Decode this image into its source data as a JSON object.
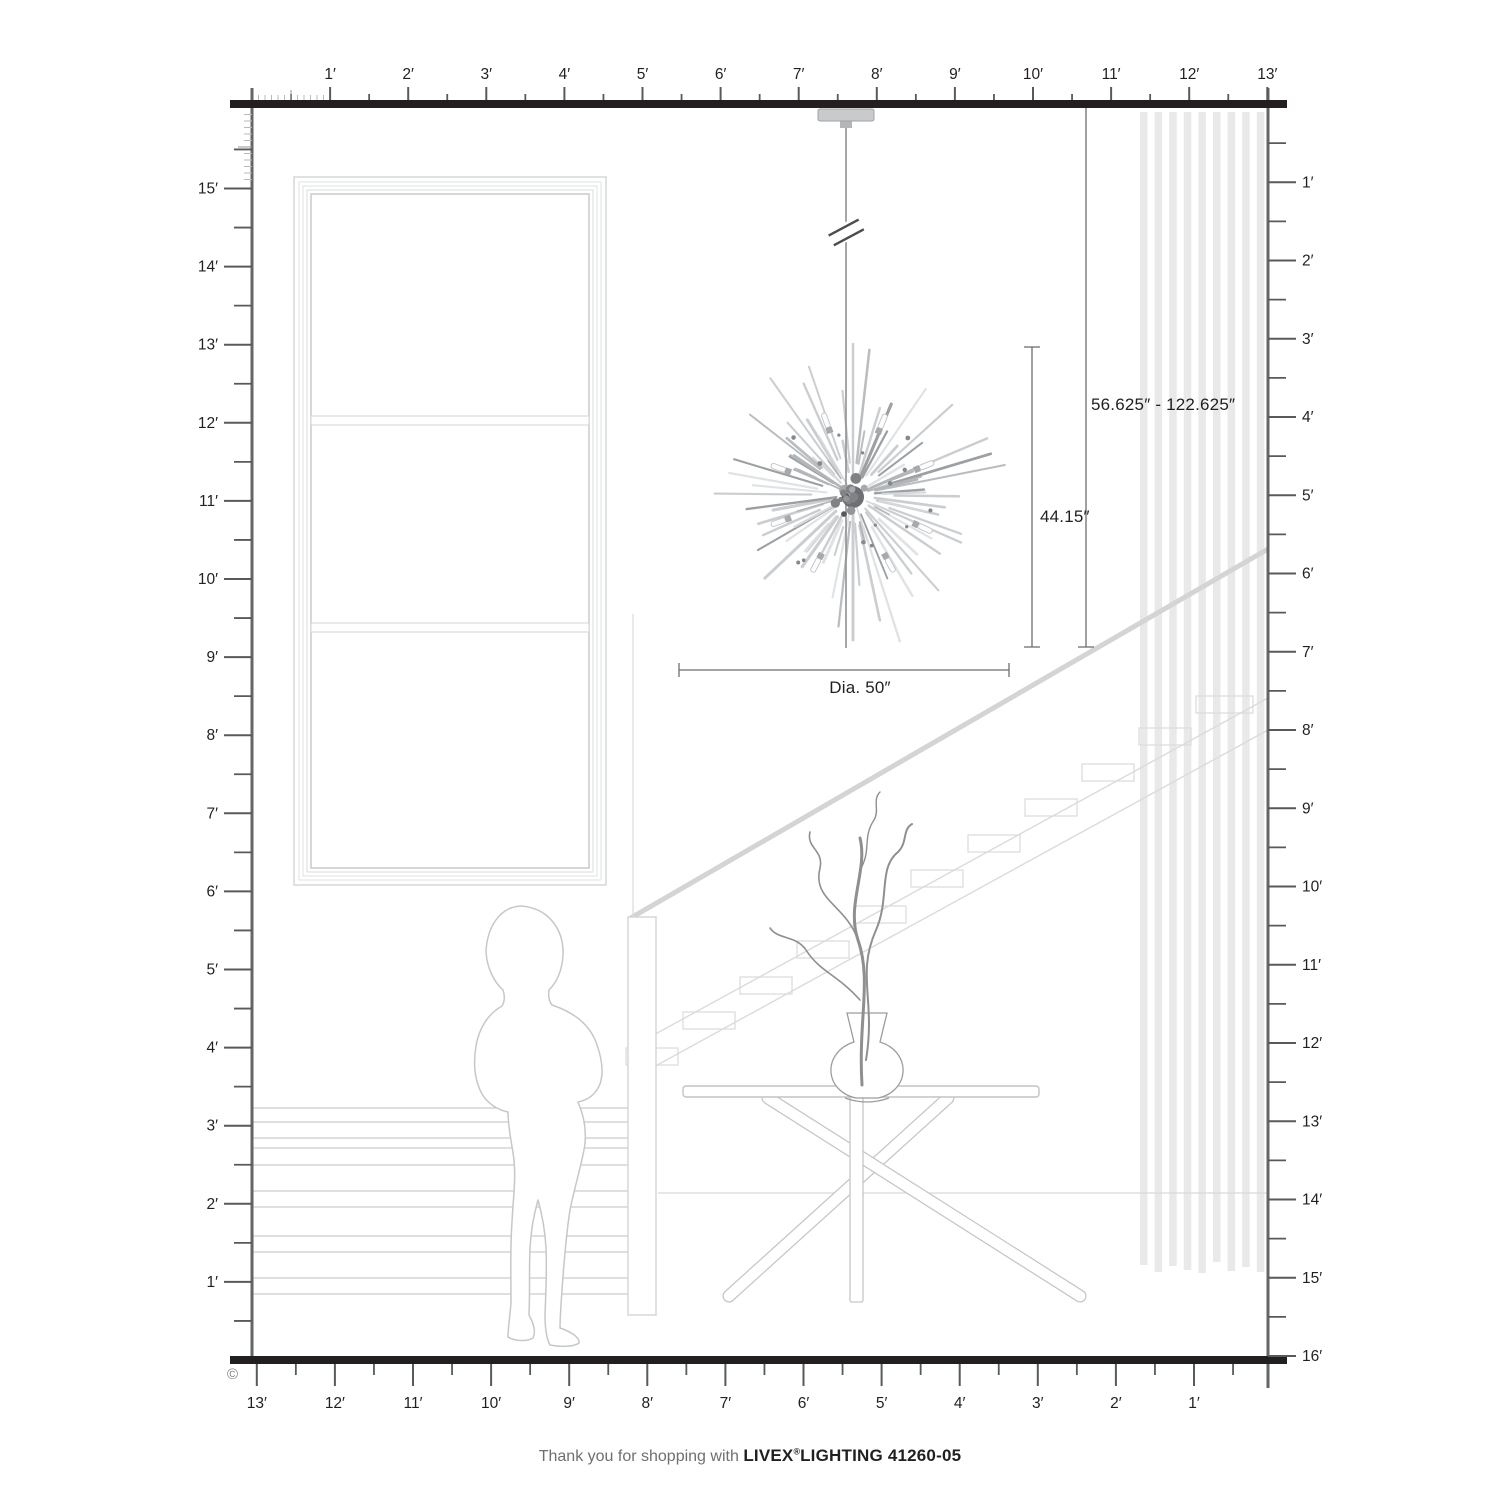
{
  "product": {
    "brand": "LIVEX",
    "registered_mark": "®",
    "brand_suffix_and_model": "LIGHTING 41260-05",
    "footer_prefix": "Thank you for shopping with",
    "copyright_symbol": "©"
  },
  "dimensions": {
    "hanging_range": "56.625″ - 122.625″",
    "fixture_height": "44.15″",
    "diameter": "Dia. 50″"
  },
  "rulers": {
    "top": [
      "1′",
      "2′",
      "3′",
      "4′",
      "5′",
      "6′",
      "7′",
      "8′",
      "9′",
      "10′",
      "11′",
      "12′",
      "13′"
    ],
    "left": [
      "15′",
      "14′",
      "13′",
      "12′",
      "11′",
      "10′",
      "9′",
      "8′",
      "7′",
      "6′",
      "5′",
      "4′",
      "3′",
      "2′",
      "1′"
    ],
    "right": [
      "1′",
      "2′",
      "3′",
      "4′",
      "5′",
      "6′",
      "7′",
      "8′",
      "9′",
      "10′",
      "11′",
      "12′",
      "13′",
      "14′",
      "15′",
      "16′"
    ],
    "bottom": [
      "13′",
      "12′",
      "11′",
      "10′",
      "9′",
      "8′",
      "7′",
      "6′",
      "5′",
      "4′",
      "3′",
      "2′",
      "1′"
    ]
  },
  "colors": {
    "structure_black": "#231f20",
    "wall_gray": "#636466",
    "tick_gray": "#58595b",
    "fine_tick": "#b9b9b9",
    "light_line": "#d2d3d4",
    "lighter_line": "#e9e9ea",
    "metal_gray": "#c9cacc",
    "text_gray": "#6d6f72"
  }
}
